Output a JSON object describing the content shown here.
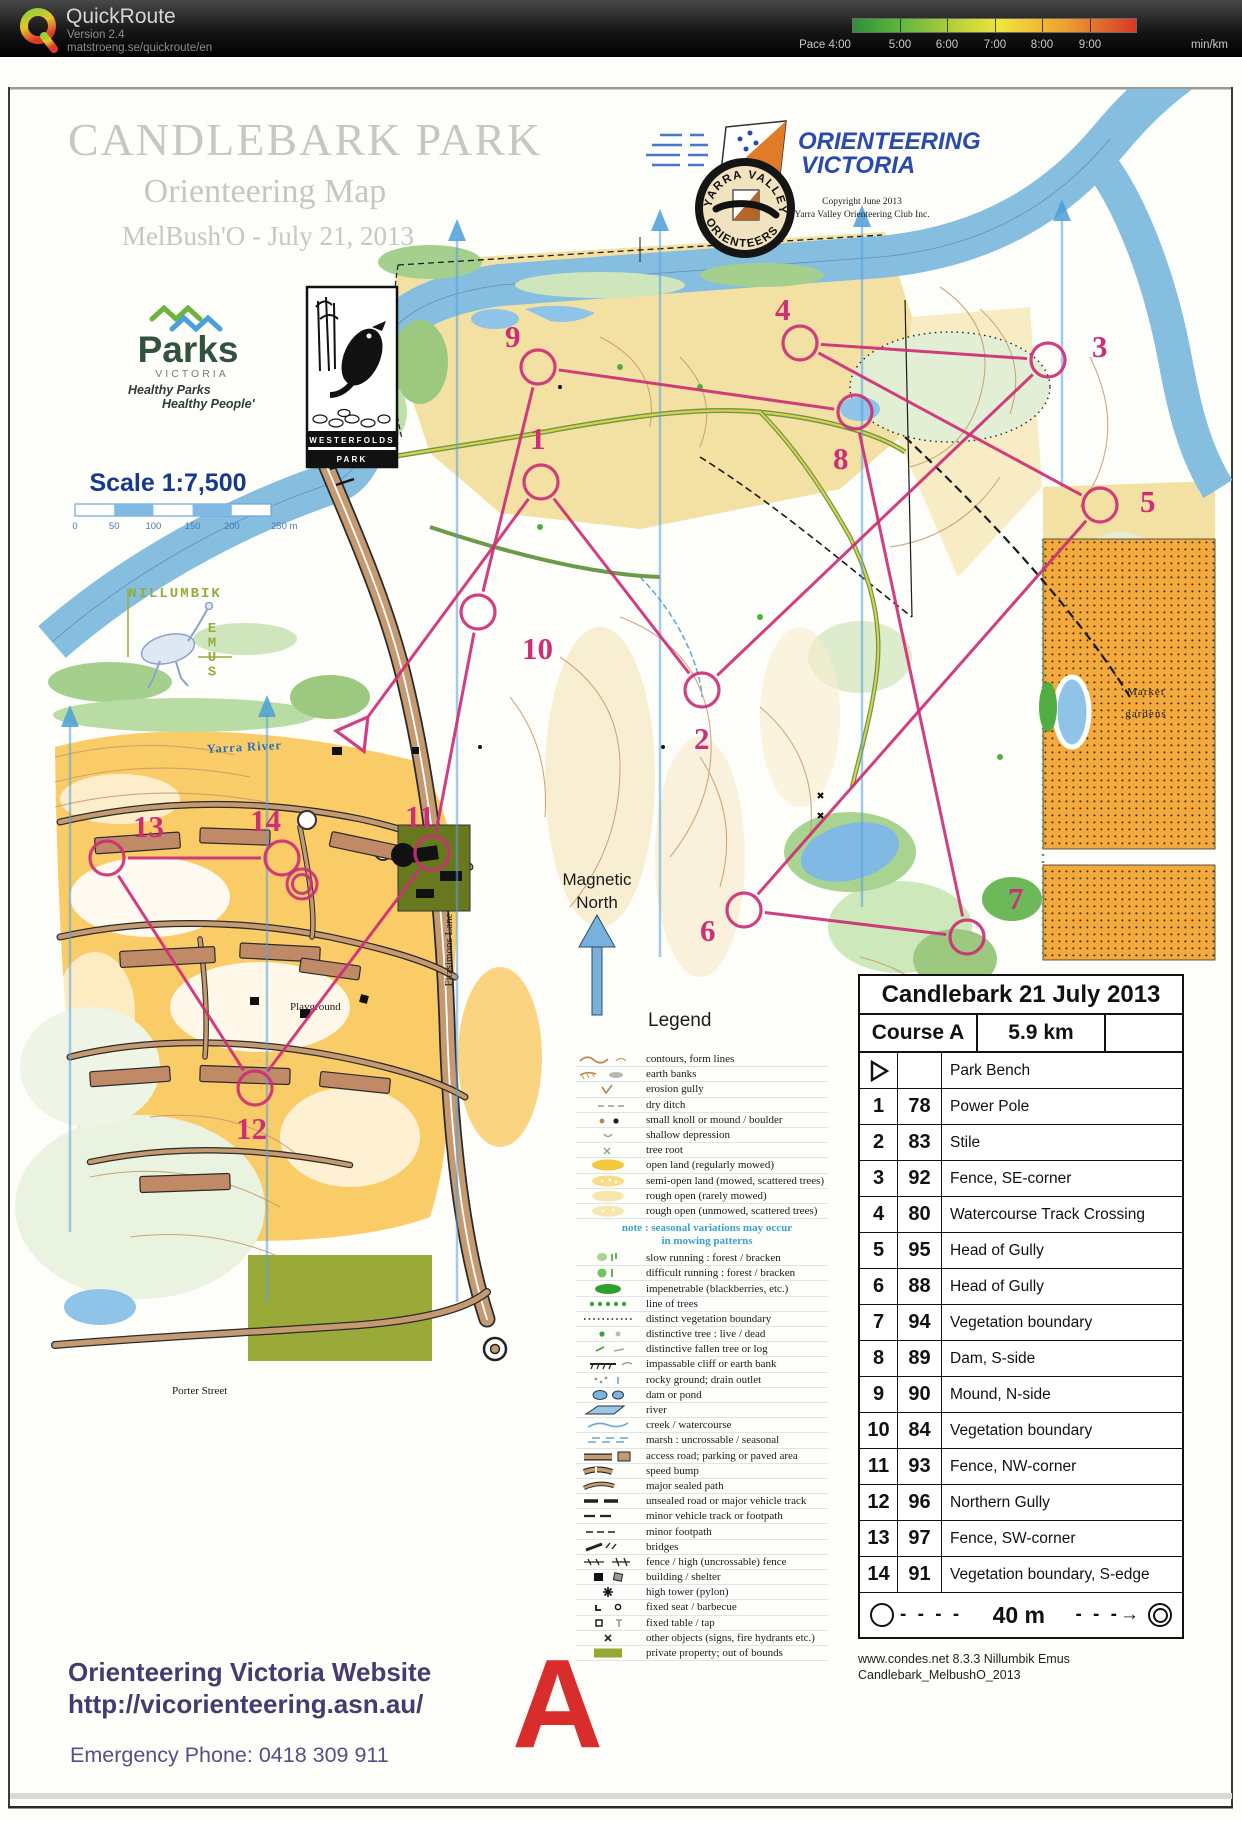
{
  "header": {
    "app_name": "QuickRoute",
    "version": "Version 2.4",
    "url": "matstroeng.se/quickroute/en",
    "pace_prefix": "Pace",
    "pace_ticks": [
      "4:00",
      "5:00",
      "6:00",
      "7:00",
      "8:00",
      "9:00"
    ],
    "pace_unit": "min/km"
  },
  "map": {
    "title": "CANDLEBARK PARK",
    "subtitle": "Orienteering Map",
    "event": "MelBush'O - July 21, 2013",
    "ov_logo_line1": "ORIENTEERING",
    "ov_logo_line2": "VICTORIA",
    "copyright_line1": "Copyright June 2013",
    "copyright_line2": "Yarra Valley Orienteering Club Inc.",
    "yv_badge_top": "YARRA VALLEY",
    "yv_badge_bottom": "ORIENTEERS",
    "parks": {
      "name": "Parks",
      "sub": "VICTORIA",
      "tag1": "Healthy Parks",
      "tag2": "Healthy People'"
    },
    "westerfolds": {
      "line1": "WESTERFOLDS",
      "line2": "PARK"
    },
    "scale_label": "Scale  1:7,500",
    "scale_ticks": [
      "0",
      "50",
      "100",
      "150",
      "200",
      "250 m"
    ],
    "nillumbik": {
      "line1": "NILLUMBIK",
      "line2": "EMUS"
    },
    "magnetic_north_1": "Magnetic",
    "magnetic_north_2": "North",
    "labels": {
      "river": "Yarra River",
      "lane": "Fitzsimons Lane",
      "market1": "Market",
      "market2": "gardens",
      "playground": "Playground",
      "street": "Porter Street"
    }
  },
  "legend": {
    "heading": "Legend",
    "note1": "note : seasonal variations may occur",
    "note2": "in mowing patterns",
    "items": [
      {
        "sym": "contours",
        "label": "contours, form lines"
      },
      {
        "sym": "earthbank",
        "label": "earth banks"
      },
      {
        "sym": "gully",
        "label": "erosion gully"
      },
      {
        "sym": "ditch",
        "label": "dry ditch"
      },
      {
        "sym": "knoll",
        "label": "small knoll or mound / boulder"
      },
      {
        "sym": "depression",
        "label": "shallow depression"
      },
      {
        "sym": "root",
        "label": "tree root"
      },
      {
        "sym": "open",
        "label": "open land (regularly mowed)"
      },
      {
        "sym": "semiopen",
        "label": "semi-open land (mowed, scattered trees)"
      },
      {
        "sym": "roughopen",
        "label": "rough open (rarely mowed)"
      },
      {
        "sym": "roughopen2",
        "label": "rough open (unmowed, scattered trees)"
      },
      {
        "sym": "slow",
        "label": "slow running :  forest / bracken"
      },
      {
        "sym": "difficult",
        "label": "difficult running : forest / bracken"
      },
      {
        "sym": "impenetrable",
        "label": "impenetrable (blackberries, etc.)"
      },
      {
        "sym": "treeline",
        "label": "line of trees"
      },
      {
        "sym": "vegboundary",
        "label": "distinct vegetation boundary"
      },
      {
        "sym": "disttree",
        "label": "distinctive tree : live / dead"
      },
      {
        "sym": "fallentree",
        "label": "distinctive fallen tree or log"
      },
      {
        "sym": "cliff",
        "label": "impassable cliff or earth bank"
      },
      {
        "sym": "rocky",
        "label": "rocky ground; drain outlet"
      },
      {
        "sym": "dam",
        "label": "dam or pond"
      },
      {
        "sym": "river",
        "label": "river"
      },
      {
        "sym": "creek",
        "label": "creek / watercourse"
      },
      {
        "sym": "marsh",
        "label": "marsh : uncrossable / seasonal"
      },
      {
        "sym": "road",
        "label": "access road; parking or paved area"
      },
      {
        "sym": "speedbump",
        "label": "speed bump"
      },
      {
        "sym": "sealedpath",
        "label": "major sealed path"
      },
      {
        "sym": "unsealed",
        "label": "unsealed road or major vehicle track"
      },
      {
        "sym": "minortrack",
        "label": "minor vehicle track or footpath"
      },
      {
        "sym": "minorfootpath",
        "label": "minor footpath"
      },
      {
        "sym": "bridge",
        "label": "bridges"
      },
      {
        "sym": "fence",
        "label": "fence / high (uncrossable) fence"
      },
      {
        "sym": "building",
        "label": "building / shelter"
      },
      {
        "sym": "tower",
        "label": "high tower (pylon)"
      },
      {
        "sym": "seat",
        "label": "fixed seat / barbecue"
      },
      {
        "sym": "tabletap",
        "label": "fixed table / tap"
      },
      {
        "sym": "other",
        "label": "other objects (signs, fire hydrants etc.)"
      },
      {
        "sym": "private",
        "label": "private property; out of bounds"
      }
    ]
  },
  "course": {
    "color": "#cd2f77",
    "start": {
      "x": 356,
      "y": 676
    },
    "finish": {
      "x": 302,
      "y": 827
    },
    "controls": [
      {
        "n": "1",
        "x": 541,
        "y": 425,
        "lx": 530,
        "ly": 392
      },
      {
        "n": "2",
        "x": 702,
        "y": 633,
        "lx": 694,
        "ly": 692
      },
      {
        "n": "3",
        "x": 1048,
        "y": 303,
        "lx": 1092,
        "ly": 300
      },
      {
        "n": "4",
        "x": 800,
        "y": 286,
        "lx": 775,
        "ly": 263
      },
      {
        "n": "5",
        "x": 1100,
        "y": 448,
        "lx": 1140,
        "ly": 455
      },
      {
        "n": "6",
        "x": 744,
        "y": 853,
        "lx": 700,
        "ly": 884
      },
      {
        "n": "7",
        "x": 967,
        "y": 880,
        "lx": 1008,
        "ly": 852
      },
      {
        "n": "8",
        "x": 855,
        "y": 355,
        "lx": 833,
        "ly": 412
      },
      {
        "n": "9",
        "x": 538,
        "y": 310,
        "lx": 505,
        "ly": 290
      },
      {
        "n": "10",
        "x": 478,
        "y": 555,
        "lx": 522,
        "ly": 602
      },
      {
        "n": "11",
        "x": 432,
        "y": 796,
        "lx": 405,
        "ly": 770
      },
      {
        "n": "12",
        "x": 255,
        "y": 1031,
        "lx": 236,
        "ly": 1082
      },
      {
        "n": "13",
        "x": 107,
        "y": 801,
        "lx": 133,
        "ly": 780
      },
      {
        "n": "14",
        "x": 282,
        "y": 801,
        "lx": 250,
        "ly": 774
      }
    ]
  },
  "control_card": {
    "title": "Candlebark 21 July 2013",
    "course": "Course A",
    "distance": "5.9 km",
    "start_desc": "Park Bench",
    "rows": [
      {
        "n": "1",
        "code": "78",
        "desc": "Power Pole"
      },
      {
        "n": "2",
        "code": "83",
        "desc": "Stile"
      },
      {
        "n": "3",
        "code": "92",
        "desc": "Fence, SE-corner"
      },
      {
        "n": "4",
        "code": "80",
        "desc": "Watercourse Track Crossing"
      },
      {
        "n": "5",
        "code": "95",
        "desc": "Head of Gully"
      },
      {
        "n": "6",
        "code": "88",
        "desc": "Head of Gully"
      },
      {
        "n": "7",
        "code": "94",
        "desc": "Vegetation boundary"
      },
      {
        "n": "8",
        "code": "89",
        "desc": "Dam, S-side"
      },
      {
        "n": "9",
        "code": "90",
        "desc": "Mound, N-side"
      },
      {
        "n": "10",
        "code": "84",
        "desc": "Vegetation boundary"
      },
      {
        "n": "11",
        "code": "93",
        "desc": "Fence, NW-corner"
      },
      {
        "n": "12",
        "code": "96",
        "desc": "Northern Gully"
      },
      {
        "n": "13",
        "code": "97",
        "desc": "Fence, SW-corner"
      },
      {
        "n": "14",
        "code": "91",
        "desc": "Vegetation boundary, S-edge"
      }
    ],
    "finish_distance": "40 m"
  },
  "footer": {
    "website_label": "Orienteering Victoria Website",
    "website_url": "http://vicorienteering.asn.au/",
    "emergency": "Emergency Phone: 0418 309 911",
    "course_letter": "A",
    "condes1": "www.condes.net 8.3.3 Nillumbik Emus",
    "condes2": "Candlebark_MelbushO_2013"
  }
}
